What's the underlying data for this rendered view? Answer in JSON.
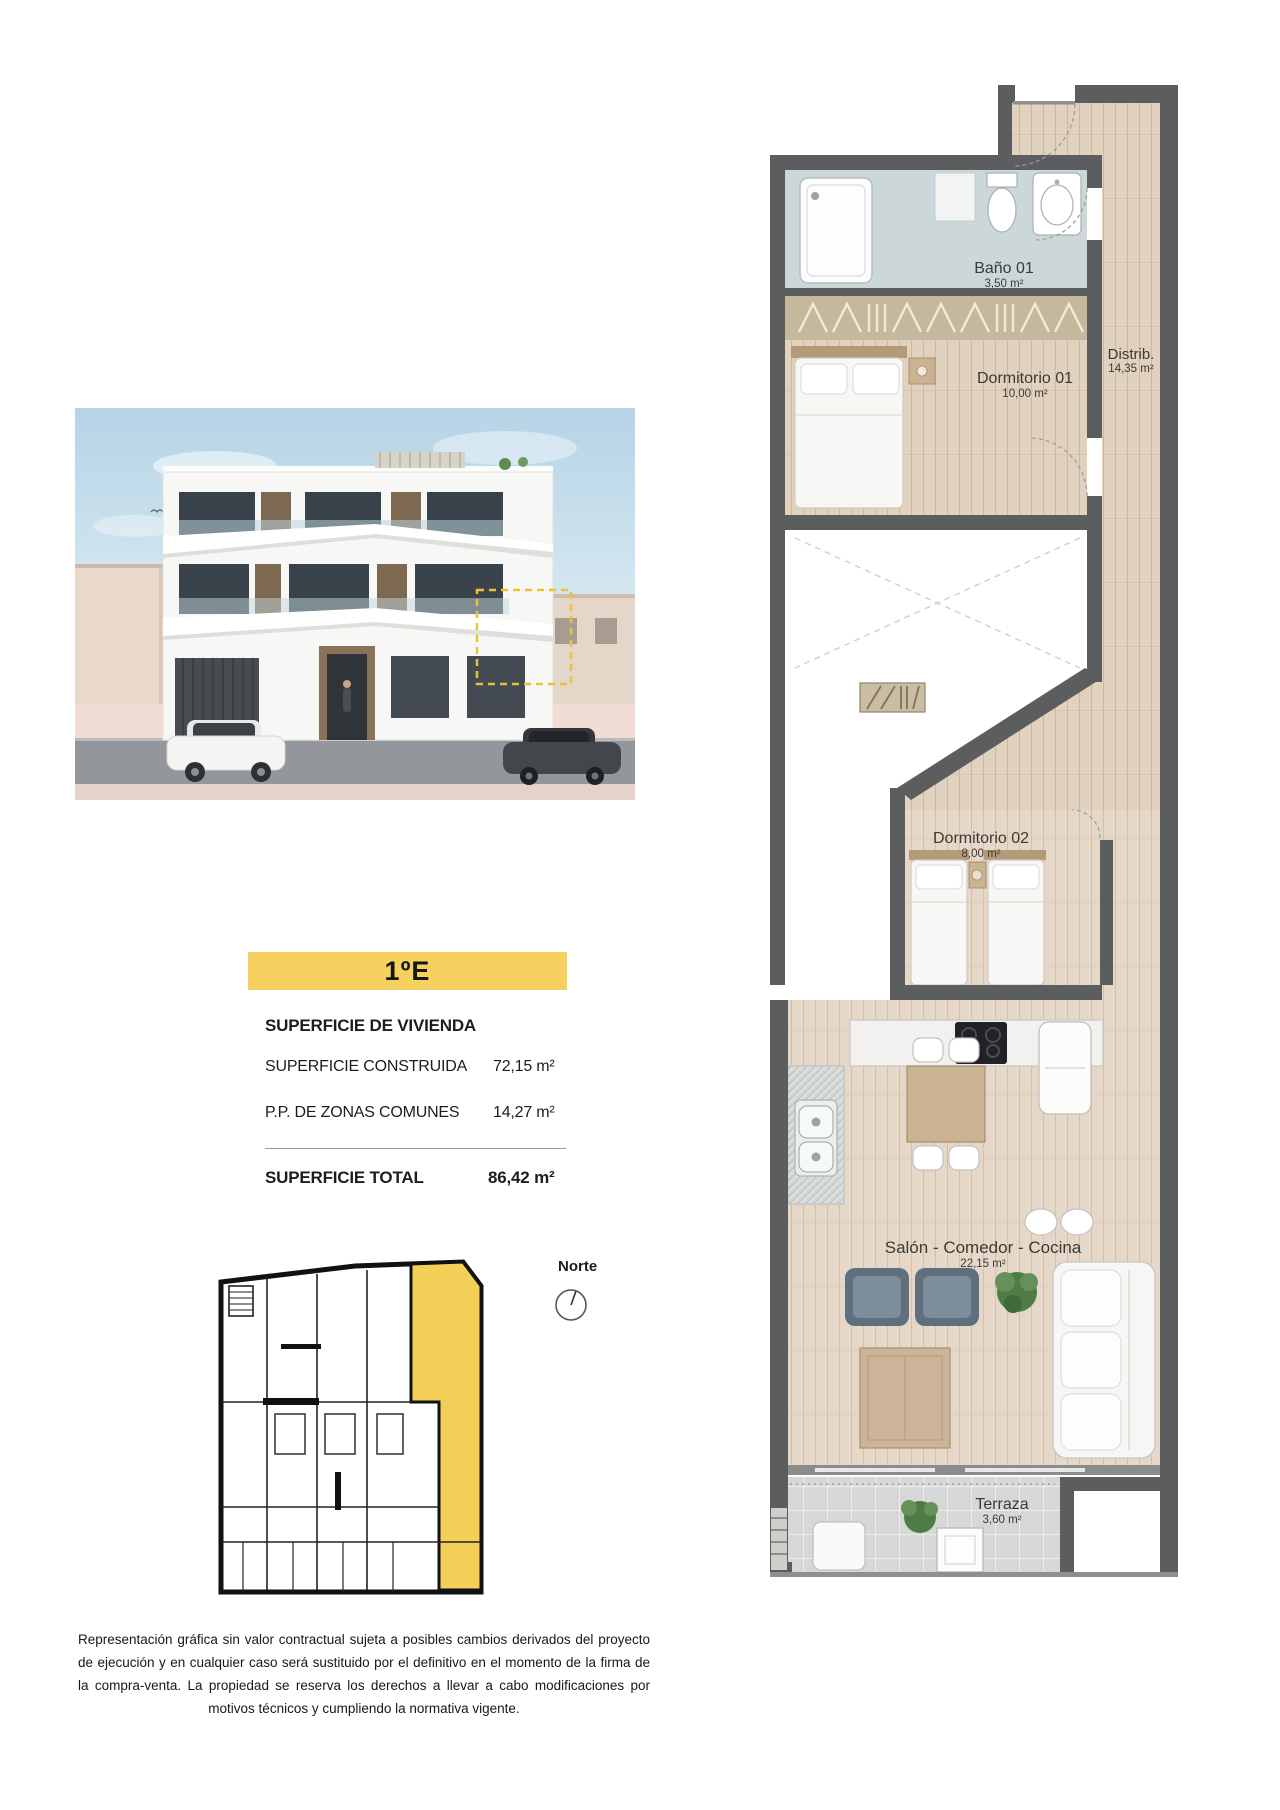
{
  "unit": {
    "label": "1ºE"
  },
  "surface": {
    "heading": "SUPERFICIE DE VIVIENDA",
    "rows": [
      {
        "label": "SUPERFICIE CONSTRUIDA",
        "value": "72,15 m²"
      },
      {
        "label": "P.P. DE ZONAS COMUNES",
        "value": "14,27 m²"
      }
    ],
    "total": {
      "label": "SUPERFICIE TOTAL",
      "value": "86,42 m²"
    }
  },
  "compass": {
    "label": "Norte"
  },
  "floor_plan": {
    "rooms": [
      {
        "name": "Baño 01",
        "area": "3,50 m²"
      },
      {
        "name": "Dormitorio 01",
        "area": "10,00 m²"
      },
      {
        "name": "Distrib.",
        "area": "14,35 m²"
      },
      {
        "name": "Dormitorio 02",
        "area": "8,00 m²"
      },
      {
        "name": "Salón - Comedor - Cocina",
        "area": "22,15 m²"
      },
      {
        "name": "Terraza",
        "area": "3,60 m²"
      }
    ]
  },
  "disclaimer": {
    "text": "Representación gráfica sin valor contractual sujeta a posibles cambios derivados del proyecto de ejecución y en cualquier caso será sustituido por el definitivo en el momento de la firma de la compra-venta. La propiedad se reserva los derechos a llevar a cabo modificaciones por motivos técnicos y cumpliendo la normativa vigente."
  },
  "colors": {
    "accent_yellow": "#f6d160",
    "wall_gray": "#5c5d5f",
    "wood_floor": "#e1d2bf",
    "highlight_dashed": "#e9c235"
  }
}
